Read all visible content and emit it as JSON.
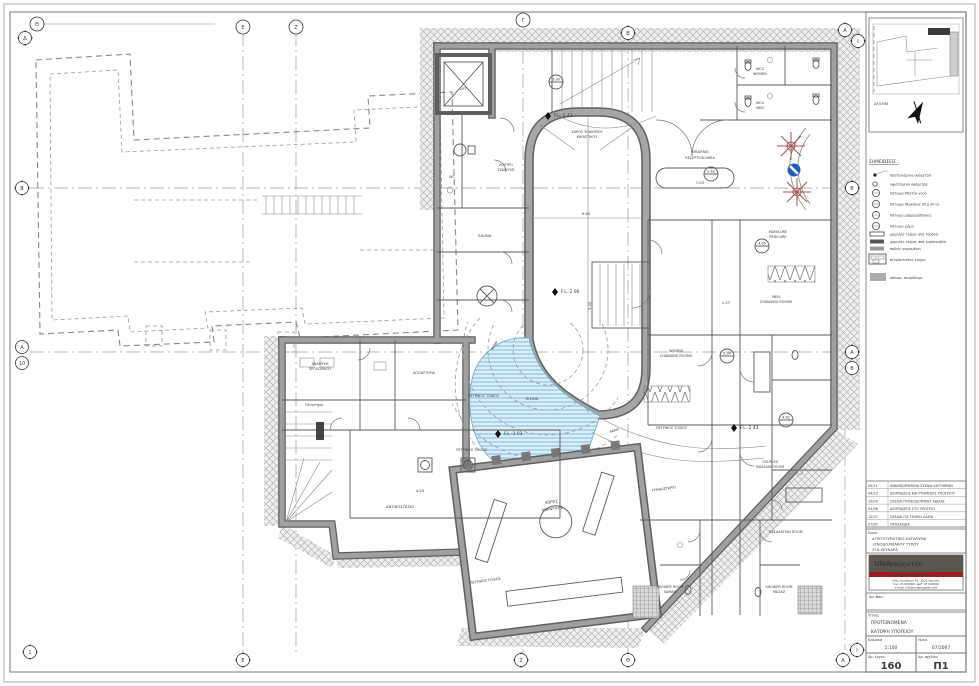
{
  "sheet": {
    "colors": {
      "pool": "#b9e2f3",
      "wall_gray": "#9a9a9a",
      "logo_red": "#9e1f1f",
      "motif_red": "#a35353",
      "icon_blue": "#1f5fc0"
    },
    "legend": {
      "title": "ΣΗΜΕΙΩΣΕΙΣ :",
      "items": [
        {
          "label": "προτεινόμενα υψόμετρα"
        },
        {
          "label": "υφιστάμενα υψόμετρα"
        },
        {
          "label": "πάτωμα Μπετόν γερό"
        },
        {
          "label": "πάτωμα πλακάκια 30 χ 30 εκ."
        },
        {
          "label": "πάτωμα μαρμαρόπλακες"
        },
        {
          "label": "πάτωμα χώμα"
        },
        {
          "label": "χαμηλός τοίχος από τούβλα"
        },
        {
          "label": "χαμηλός τοίχος από γυψότουβλα"
        },
        {
          "label": "ποδιές γεμισμένες"
        },
        {
          "label": "πετρόκτιστος τοίχος"
        },
        {
          "label": "οπλισμ. σκυρόδεμα"
        }
      ]
    },
    "keyplan": {
      "ref": "ΑΛ/1938"
    },
    "revisions": [
      {
        "d": "05/11",
        "t": "ΑΝΑΘΕΩΡΗΜΕΝΑ ΣΧΕΔΙΑ ΚΑΤΟΨΕΩΝ"
      },
      {
        "d": "04/10",
        "t": "ΔΙΟΡΘΩΣΕΙΣ ΚΑΙ ΡΥΘΜΙΣΕΙΣ ΥΠΟΓΕΙΟΥ"
      },
      {
        "d": "10/09",
        "t": "ΣΧΕΔΙΑ ΠΟΛΕΟΔΟΜΙΚΗΣ ΑΔΕΙΑΣ"
      },
      {
        "d": "04/08",
        "t": "ΔΙΟΡΘΩΣΕΙΣ ΣΤΟ ΥΠΟΓΕΙΟ"
      },
      {
        "d": "12/07",
        "t": "ΣΧΕΔΙΑ ΓΙΑ ΤΕΛΙΚΗ ΑΔΕΙΑ"
      },
      {
        "d": "07/07",
        "t": "ΠΡΟΣΧΕΔΙΑ"
      }
    ],
    "project": {
      "label": "Έργο:",
      "line1": "ΑΓΡΟΤΟΥΡΙΣΤΙΚΟ ΚΑΤΑΛΥΜΑ",
      "line2": "ΞΕΝΟΔΟΧΕΙΑΚΟΥ ΤΥΠΟΥ",
      "line3": "ΣΤΑ ΛΕΥΚΑΡΑ"
    },
    "logo": {
      "brand1": "UNA",
      "brand2": "PROGETTO",
      "band": "ΑΡΧΙΤΕΚΤΟΝΙΚΕΣ ΜΕΛΕΤΕΣ",
      "addr1": "οδός Λευκάρων 41, 3100 Λεμεσός",
      "addr2": "τηλ: 25 000000, φαξ: 25 000000",
      "addr3": "e-mail: info@unaprogetto.com"
    },
    "file_label": "Αρ. Φακ.",
    "titlebox": {
      "label": "Τίτλος",
      "line1": "ΠΡΟΤΕΙΝΟΜΕΝΑ",
      "line2": "ΚΑΤΟΨΗ ΥΠΟΓΕΙΟΥ"
    },
    "scale": {
      "label": "Κλίμακα",
      "value": "1:100"
    },
    "date": {
      "label": "Ημερ.",
      "value": "07/2007"
    },
    "job": {
      "label": "Αρ. έργου",
      "value": "160"
    },
    "drawing": {
      "label": "Αρ. σχεδίου",
      "value": "Π1"
    }
  },
  "grid": {
    "top": [
      "Θ",
      "Δ",
      "Ε",
      "Ζ",
      "Γ",
      "Β",
      "Α",
      "Ι"
    ],
    "left": [
      "Β",
      "Α",
      "10"
    ],
    "right": [
      "Β",
      "Α",
      "Β"
    ],
    "bottom": [
      "1",
      "Ε",
      "Ζ",
      "Θ",
      "Α",
      "Ι"
    ]
  },
  "plan": {
    "rooms": [
      "WCS",
      "WOMEN",
      "WCS",
      "MEN",
      "ΜΠΑΡΑΚΙ",
      "RECEPTION AREA",
      "MANICURE",
      "PEDICURE",
      "MEN",
      "CHANGING ROOMS",
      "WOMEN",
      "CHANGING ROOMS",
      "ΓΥΜΝΑΣΤΗΡΙΟ",
      "COUPLES",
      "MASSAGE ROOM",
      "RELAXATION ROOM",
      "SHOWER ROOM",
      "ΧΑΜΑΜ",
      "SHOWER ROOM",
      "ΜΑΣΑΖ",
      "SAUNA",
      "ΛΟΥΤΡΟ",
      "ΤΖΑΚΟΥΖΙ",
      "ΧΩΡΟΣ ΥΠΑΙΘΡΙΟΥ",
      "ΚΑΘΙΣΤΙΚΟΥ",
      "ΧΩΡΟΣ",
      "ΑΝΑΨΥΧΗΣ",
      "ΑΝΑΨΥΧΗ",
      "ΠΡΟΣΩΠΙΚΟΥ",
      "Πλυντήριο",
      "ΑΠΟΔΥΤΗΡΙΑ",
      "ΑΝΤΛΙΟΣΤΑΣΙΟ",
      "ΠΙΣΙΝΑ",
      "LIFT",
      "WC"
    ],
    "levels": [
      "F.L.-2.43",
      "F.L.-2.96",
      "F.L.-3.03",
      "F.L.-2.43"
    ],
    "notes": [
      "ΠΕΤΡΙΝΟΣ ΤΟΙΧΟΣ",
      "ΠΕΤΡΙΝΟΣ ΤΟΙΧΟΣ",
      "ΠΕΤΡΙΝΟΣ ΤΟΙΧΟΣ",
      "ΠΕΤΡΙΝΟΣ ΤΟΙΧΟΣ",
      "RAMP",
      "RAMP"
    ],
    "dims": [
      "9.80",
      "3.20",
      "7.03",
      "1.27",
      "4.23"
    ],
    "tags": [
      "2.62",
      "4.65",
      "5.34",
      "4.82",
      "3.90"
    ]
  }
}
